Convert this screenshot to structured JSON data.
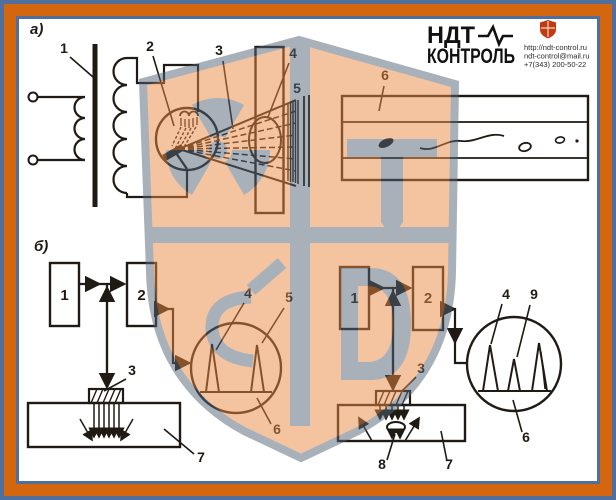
{
  "brand": {
    "line1": "НДТ",
    "line2": "КОНТРОЛЬ",
    "website": "http://ndt-control.ru",
    "email": "ndt-control@mail.ru",
    "phone": "+7(343) 200-50-22"
  },
  "colors": {
    "frame_orange": "#d4670e",
    "frame_steel": "#4f6f9e",
    "content_bg": "#ffffff",
    "ink": "#201a14",
    "watermark_peach": "#eb8b45",
    "watermark_gray": "#536575",
    "brand_shield_red": "#c13a10"
  },
  "figure": {
    "section_a": "а)",
    "section_b": "б)",
    "a_callouts": {
      "c1": "1",
      "c2": "2",
      "c3": "3",
      "c4": "4",
      "c5": "5",
      "c6": "6"
    },
    "b_left": {
      "box1": "1",
      "box2": "2",
      "c3": "3",
      "c4": "4",
      "c5": "5",
      "c6": "6",
      "c7": "7"
    },
    "b_right": {
      "box1": "1",
      "box2": "2",
      "c3": "3",
      "c4": "4",
      "c9": "9",
      "c6": "6",
      "c7": "7",
      "c8": "8"
    }
  }
}
